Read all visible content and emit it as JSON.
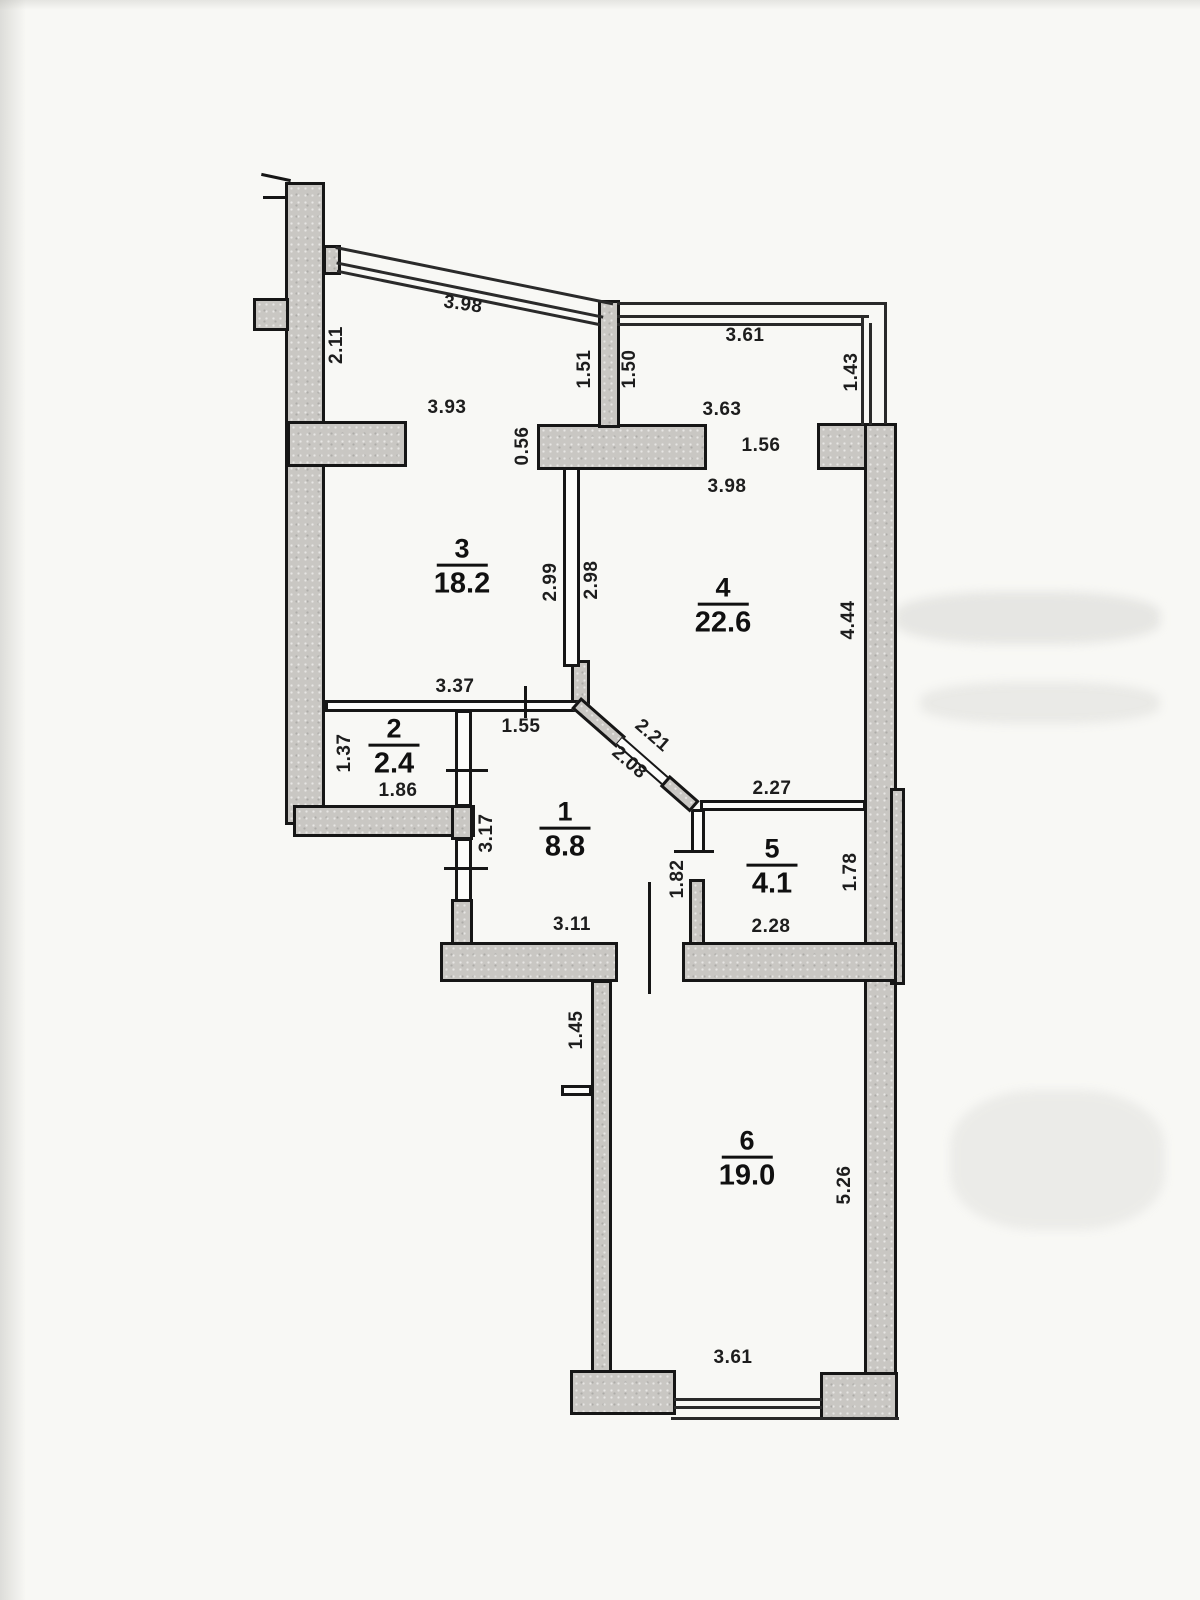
{
  "plan": {
    "type": "apartment-floor-plan",
    "wall_fill_color": "#c9c7c3",
    "line_color": "#161616",
    "paper_color": "#f8f8f5"
  },
  "rooms": {
    "r1": {
      "number": "1",
      "area": "8.8"
    },
    "r2": {
      "number": "2",
      "area": "2.4"
    },
    "r3": {
      "number": "3",
      "area": "18.2"
    },
    "r4": {
      "number": "4",
      "area": "22.6"
    },
    "r5": {
      "number": "5",
      "area": "4.1"
    },
    "r6": {
      "number": "6",
      "area": "19.0"
    }
  },
  "dims": {
    "loggia_left_glazing": "3.98",
    "loggia_left_side": "2.11",
    "loggia_left_bottom": "3.93",
    "balcony_divider_left": "1.51",
    "balcony_divider_right": "1.50",
    "loggia_right_top": "3.61",
    "loggia_right_side": "1.43",
    "loggia_right_bottom": "3.63",
    "room4_balcony_opening": "1.56",
    "room4_top": "3.98",
    "wall_segment": "0.56",
    "room3_right": "2.99",
    "room4_left": "2.98",
    "room4_right": "4.44",
    "room3_bottom": "3.37",
    "hall_top_opening": "1.55",
    "room2_left": "1.37",
    "room2_bottom": "1.86",
    "diag_wall_outer": "2.21",
    "diag_wall_inner": "2.08",
    "room5_top": "2.27",
    "hall_left": "3.17",
    "room5_left": "1.82",
    "room5_right": "1.78",
    "room5_bottom": "2.28",
    "hall_bottom": "3.11",
    "room6_left_offset": "1.45",
    "room6_right": "5.26",
    "room6_bottom": "3.61"
  }
}
